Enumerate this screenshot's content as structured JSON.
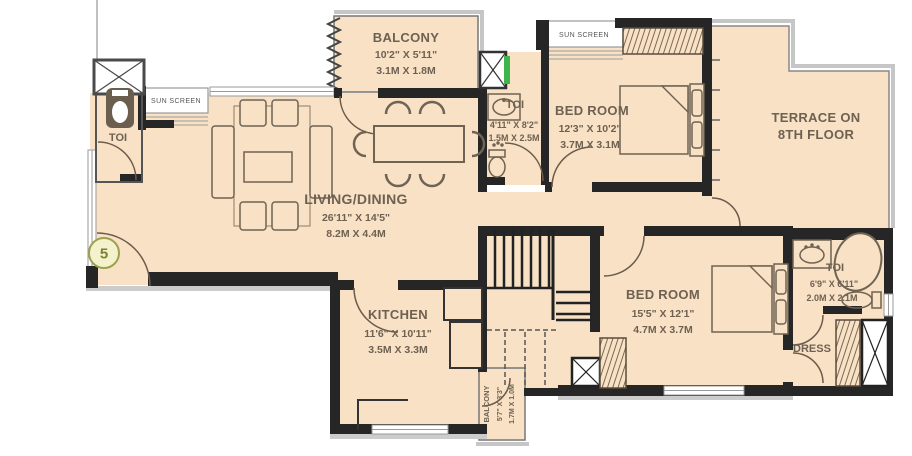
{
  "plan": {
    "unit_number": "5",
    "sun_screen_label": "SUN SCREEN",
    "rooms": {
      "balcony_top": {
        "name": "BALCONY",
        "dim_ft": "10'2\" X 5'11\"",
        "dim_m": "3.1M X 1.8M"
      },
      "toi_left": {
        "name": "TOI"
      },
      "living_dining": {
        "name": "LIVING/DINING",
        "dim_ft": "26'11\" X 14'5\"",
        "dim_m": "8.2M X 4.4M"
      },
      "toi_mid": {
        "name": "TOI",
        "dim_ft": "4'11\" X 8'2\"",
        "dim_m": "1.5M X 2.5M"
      },
      "bedroom_top": {
        "name": "BED ROOM",
        "dim_ft": "12'3\" X 10'2\"",
        "dim_m": "3.7M X 3.1M"
      },
      "terrace": {
        "name_line1": "TERRACE ON",
        "name_line2": "8TH FLOOR"
      },
      "kitchen": {
        "name": "KITCHEN",
        "dim_ft": "11'6\" X 10'11\"",
        "dim_m": "3.5M X 3.3M"
      },
      "balcony_bottom": {
        "name": "BALCONY",
        "dim_ft": "5'7\" X 3'3\"",
        "dim_m": "1.7M X 1.0M"
      },
      "bedroom_bottom": {
        "name": "BED ROOM",
        "dim_ft": "15'5\" X 12'1\"",
        "dim_m": "4.7M X 3.7M"
      },
      "toi_right": {
        "name": "TOI",
        "dim_ft": "6'9\" X 6'11\"",
        "dim_m": "2.0M X 2.1M"
      },
      "dress": {
        "name": "DRESS"
      }
    },
    "colors": {
      "room_fill": "#f8e1c5",
      "wall": "#262626",
      "text": "#6e6152",
      "accent_green": "#3db54a"
    }
  }
}
